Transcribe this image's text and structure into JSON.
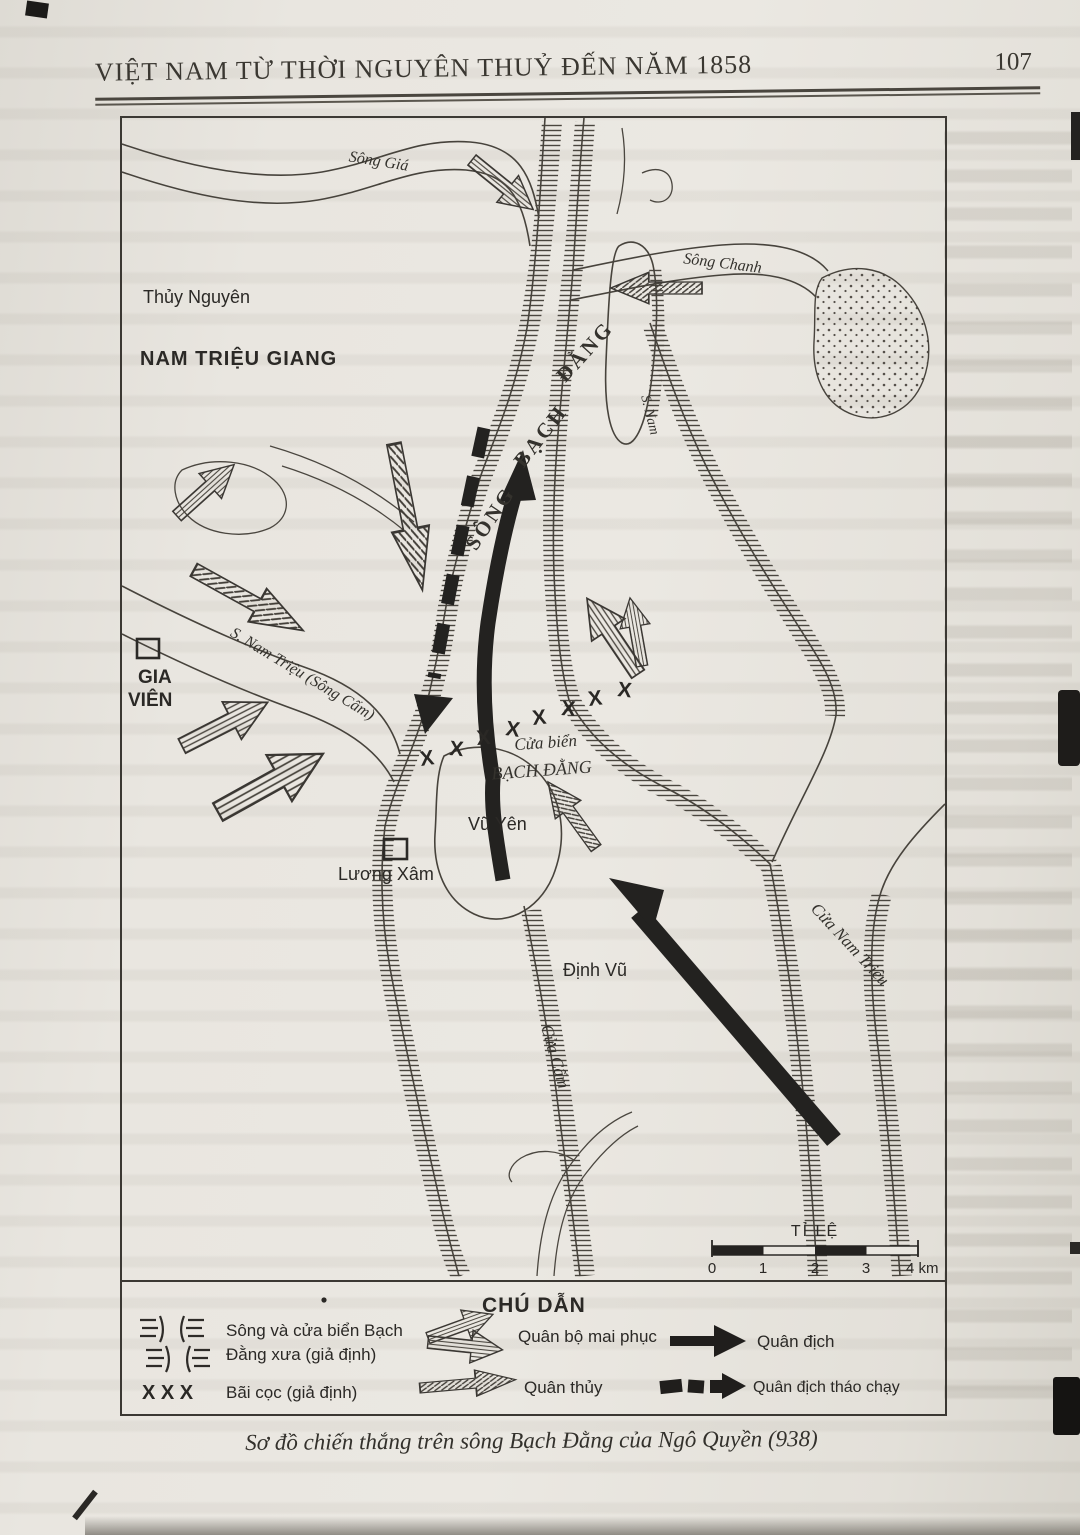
{
  "header": {
    "title": "VIỆT NAM TỪ THỜI NGUYÊN THUỶ ĐẾN NĂM 1858",
    "page_number": "107"
  },
  "map": {
    "labels": {
      "song_gia": "Sông Giá",
      "thuy_nguyen": "Thủy Nguyên",
      "nam_trieu_giang": "NAM TRIỆU GIANG",
      "song_chanh": "Sông Chanh",
      "bach_dang_words": [
        "SÔNG",
        "BẠCH",
        "ĐẰNG"
      ],
      "s_nam": "S. Nam",
      "gia_vien_line1": "GIA",
      "gia_vien_line2": "VIÊN",
      "s_nam_trieu": "S. Nam Triệu (Sông Cấm)",
      "cua_bien_line1": "Cửa biển",
      "cua_bien_line2": "BẠCH ĐẰNG",
      "vu_yen": "Vũ Yên",
      "luong_xam": "Lương Xâm",
      "dinh_vu": "Định Vũ",
      "cua_cam": "Cửa Cấm",
      "cua_nam_trieu": "Cửa Nam Triệu"
    },
    "stake_mark": "X",
    "scale": {
      "title": "TỈ LỆ",
      "ticks": [
        "0",
        "1",
        "2",
        "3",
        "4 km"
      ]
    }
  },
  "legend": {
    "title": "CHÚ DẪN",
    "river": {
      "label_line1": "Sông và cửa biển Bạch",
      "label_line2": "Đằng xưa (giả định)"
    },
    "stakes": {
      "symbol": "X X X",
      "label": "Bãi cọc (giả định)"
    },
    "ambush": {
      "label": "Quân bộ mai phục"
    },
    "navy": {
      "label": "Quân thủy"
    },
    "enemy": {
      "label": "Quân địch"
    },
    "enemy_flee": {
      "label": "Quân địch tháo chạy"
    }
  },
  "caption": "Sơ đồ chiến thắng trên sông Bạch Đằng của Ngô Quyền (938)",
  "colors": {
    "paper": "#e7e4de",
    "ink": "#2c2a27",
    "map_line": "#47433c"
  }
}
